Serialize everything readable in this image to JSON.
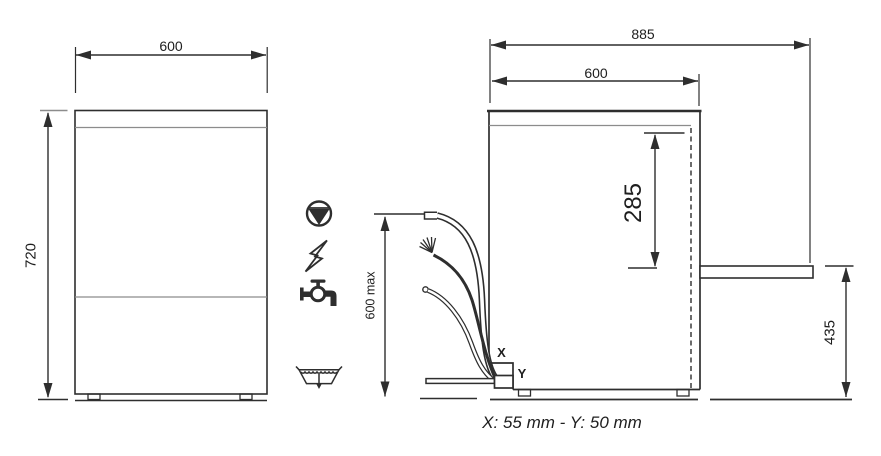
{
  "title": "Appliance installation dimensions drawing",
  "front_view": {
    "width_label": "600",
    "height_label": "720"
  },
  "side_view": {
    "overall_depth_label": "885",
    "body_depth_label": "600",
    "drain_outlet_span_label": "285",
    "drain_outlet_height_label": "435",
    "hose_reach_label": "600 max",
    "x_marker_label": "X",
    "y_marker_label": "Y"
  },
  "legend_icons": {
    "drain_pump": "drain-pump-icon",
    "electricity": "electric-power-icon",
    "water_supply": "water-tap-icon",
    "floor_drain": "floor-drain-icon"
  },
  "footer": {
    "caption": "X: 55 mm - Y: 50 mm"
  },
  "colors": {
    "line": "#2e2e2e",
    "secondary_line": "#8c8c8c",
    "background": "#ffffff"
  }
}
